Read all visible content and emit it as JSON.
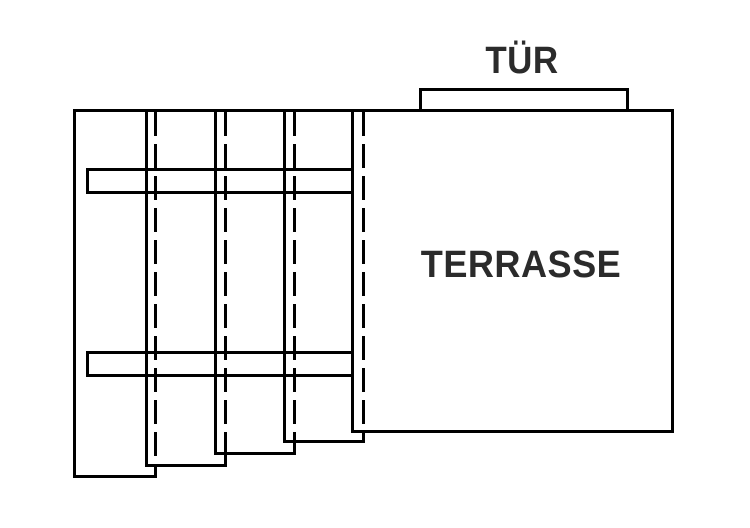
{
  "diagram": {
    "labels": {
      "door": "TÜR",
      "terrace": "TERRASSE"
    },
    "colors": {
      "line": "#000000",
      "text": "#2b2b2b",
      "fill": "#ffffff",
      "background": "#ffffff"
    }
  }
}
